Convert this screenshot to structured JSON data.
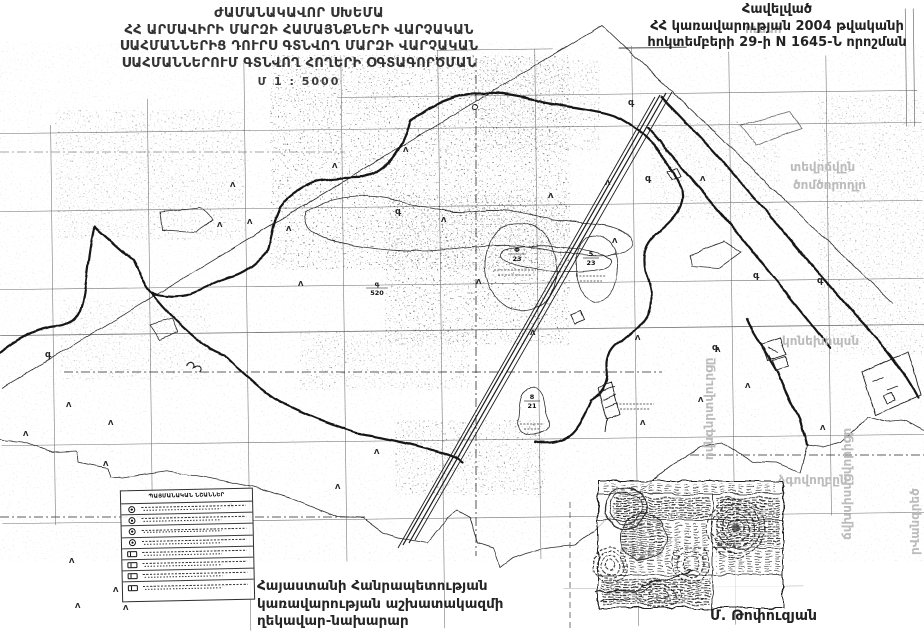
{
  "document": {
    "title_block": {
      "line1": "ԺԱՄԱՆԱԿԱՎՈՐ ՍԽԵՄԱ",
      "line2": "ՀՀ ԱՐՄԱՎԻՐԻ ՄԱՐԶԻ ՀԱՄԱՅՆՔՆԵՐԻ ՎԱՐՉԱԿԱՆ",
      "line3": "ՍԱՀՄԱՆՆԵՐԻՑ ԴՈՒՐՍ ԳՏՆՎՈՂ ՄԱՐԶԻ ՎԱՐՉԱԿԱՆ",
      "line4": "ՍԱՀՄԱՆՆԵՐՈՒՄ ԳՏՆՎՈՂ ՀՈՂԵՐԻ ՕԳՏԱԳՈՐԾՄԱՆ",
      "scale": "Մ 1 : 5000"
    },
    "annex_block": {
      "line1": "Հավելված",
      "line2": "ՀՀ կառավարության 2004 թվականի",
      "line3": "հոկտեմբերի 29-ի N 1645-Ն որոշման"
    },
    "signature_block": {
      "line1": "Հայաստանի Հանրապետության",
      "line2": "կառավարության աշխատակազմի",
      "line3": "ղեկավար-նախարար"
    },
    "signer_name": "Մ. Թոփուզյան"
  },
  "legend": {
    "header": "ՊԱՅՄԱՆԱԿԱՆ ՆՇԱՆՆԵՐ",
    "rows": [
      {
        "shape": "circle"
      },
      {
        "shape": "circle"
      },
      {
        "shape": "circle"
      },
      {
        "shape": "circle"
      },
      {
        "shape": "box"
      },
      {
        "shape": "box"
      },
      {
        "shape": "box"
      },
      {
        "shape": "box"
      }
    ]
  },
  "map": {
    "glyphs": {
      "tree": "Λ",
      "g": "գ"
    },
    "parcels": [
      {
        "num": "Փ",
        "den": "23"
      },
      {
        "num": "5",
        "den": "23"
      },
      {
        "num": "8",
        "den": "21"
      },
      {
        "num": "գ",
        "den": "520"
      }
    ],
    "stamp_note": "N 478",
    "ghost_fragments": [
      "ուեսո",
      "տեվրճվըն",
      "ծոմծորողլո",
      "կոնեխոպսն",
      "ձգովողբըն",
      "ովնգնրտվուրցը",
      "ճվխսիսվցվորիցր",
      "րՎանգրեծ"
    ]
  },
  "colors": {
    "ink": "#1c1c1c",
    "ghost": "#bcbcbc",
    "paper": "#ffffff"
  }
}
